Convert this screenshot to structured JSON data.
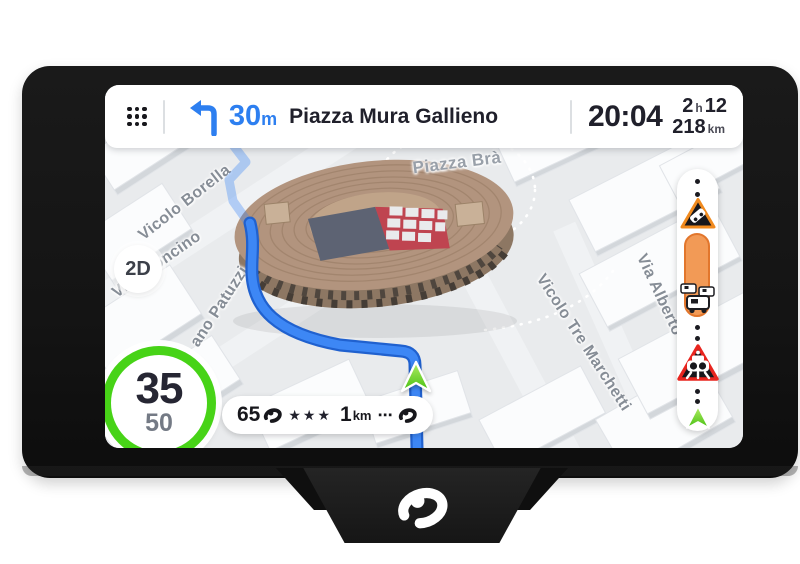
{
  "device": {
    "brand_logo": "coyote-logo"
  },
  "top_bar": {
    "menu_icon": "grid-menu-icon",
    "maneuver_icon": "turn-left-arrow-icon",
    "distance_value": "30",
    "distance_unit": "m",
    "street": "Piazza Mura Gallieno",
    "time": "20:04",
    "eta_hours": "2",
    "eta_hours_unit": "h",
    "eta_minutes": "12",
    "remaining_distance": "218",
    "remaining_distance_unit": "km"
  },
  "map": {
    "view_button": "2D",
    "landmark": "verona-arena-3d-building",
    "labels": [
      {
        "text": "Vicolo Borella"
      },
      {
        "text": "Via Leoncino"
      },
      {
        "text": "ano Patuzzi"
      },
      {
        "text": "Piazza Brà"
      },
      {
        "text": "Vicolo Tre Marchetti"
      },
      {
        "text": "Via Alberto"
      }
    ]
  },
  "speedometer": {
    "current_speed": "35",
    "speed_limit": "50"
  },
  "alert_pill": {
    "speed": "65",
    "stars": "★★★",
    "distance_value": "1",
    "distance_unit": "km",
    "more_dots": "⋯"
  },
  "route_bar": {
    "icons": [
      "accident-warning-icon",
      "traffic-jam-segment",
      "traffic-jam-icon",
      "speed-camera-icon",
      "position-arrow-icon"
    ]
  },
  "colors": {
    "accent_blue": "#2d7ff0",
    "route_blue": "#3d87f5",
    "speed_ring_green": "#47d317",
    "position_arrow_green": "#5ecb22",
    "alert_orange": "#f29a56",
    "camera_red": "#e8251f",
    "map_background": "#e9ebed"
  }
}
